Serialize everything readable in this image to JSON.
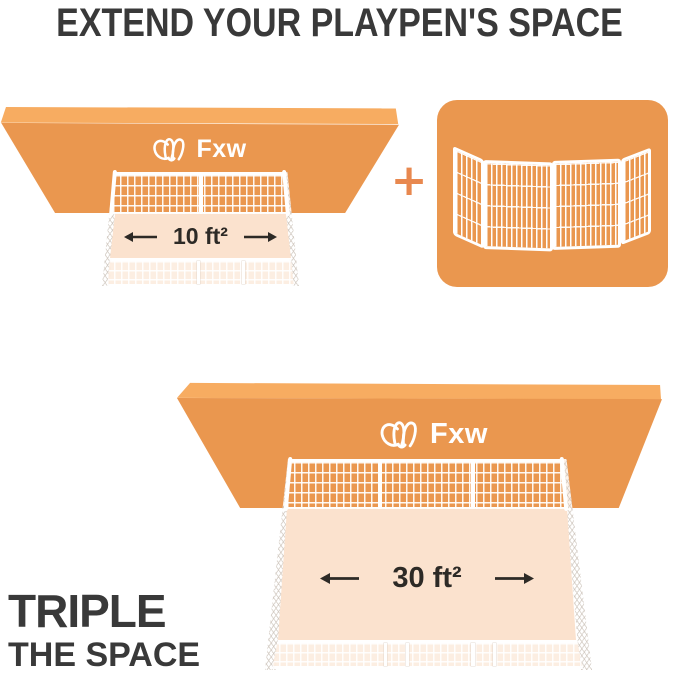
{
  "title": "EXTEND YOUR PLAYPEN'S SPACE",
  "brand": {
    "logo_text": "Fxw"
  },
  "equation": {
    "plus_symbol": "+"
  },
  "scenes": {
    "top": {
      "area_label": "10 ft²"
    },
    "bottom": {
      "area_label": "30 ft²"
    }
  },
  "footer": {
    "headline": "TRIPLE",
    "subheadline": "THE SPACE"
  },
  "icons": {
    "brand_mark": "dog-face-line-logo",
    "arrows": "left-right-width-arrows",
    "plus": "plus-sign"
  },
  "colors": {
    "orange": "#EA974F",
    "orange_light": "#F7AC61",
    "peach": "#FBE2CE",
    "peach_wall": "#FCEDE0",
    "plus_orange": "#E8884F",
    "text_dark": "#393939",
    "label_dark": "#2D2A26"
  }
}
